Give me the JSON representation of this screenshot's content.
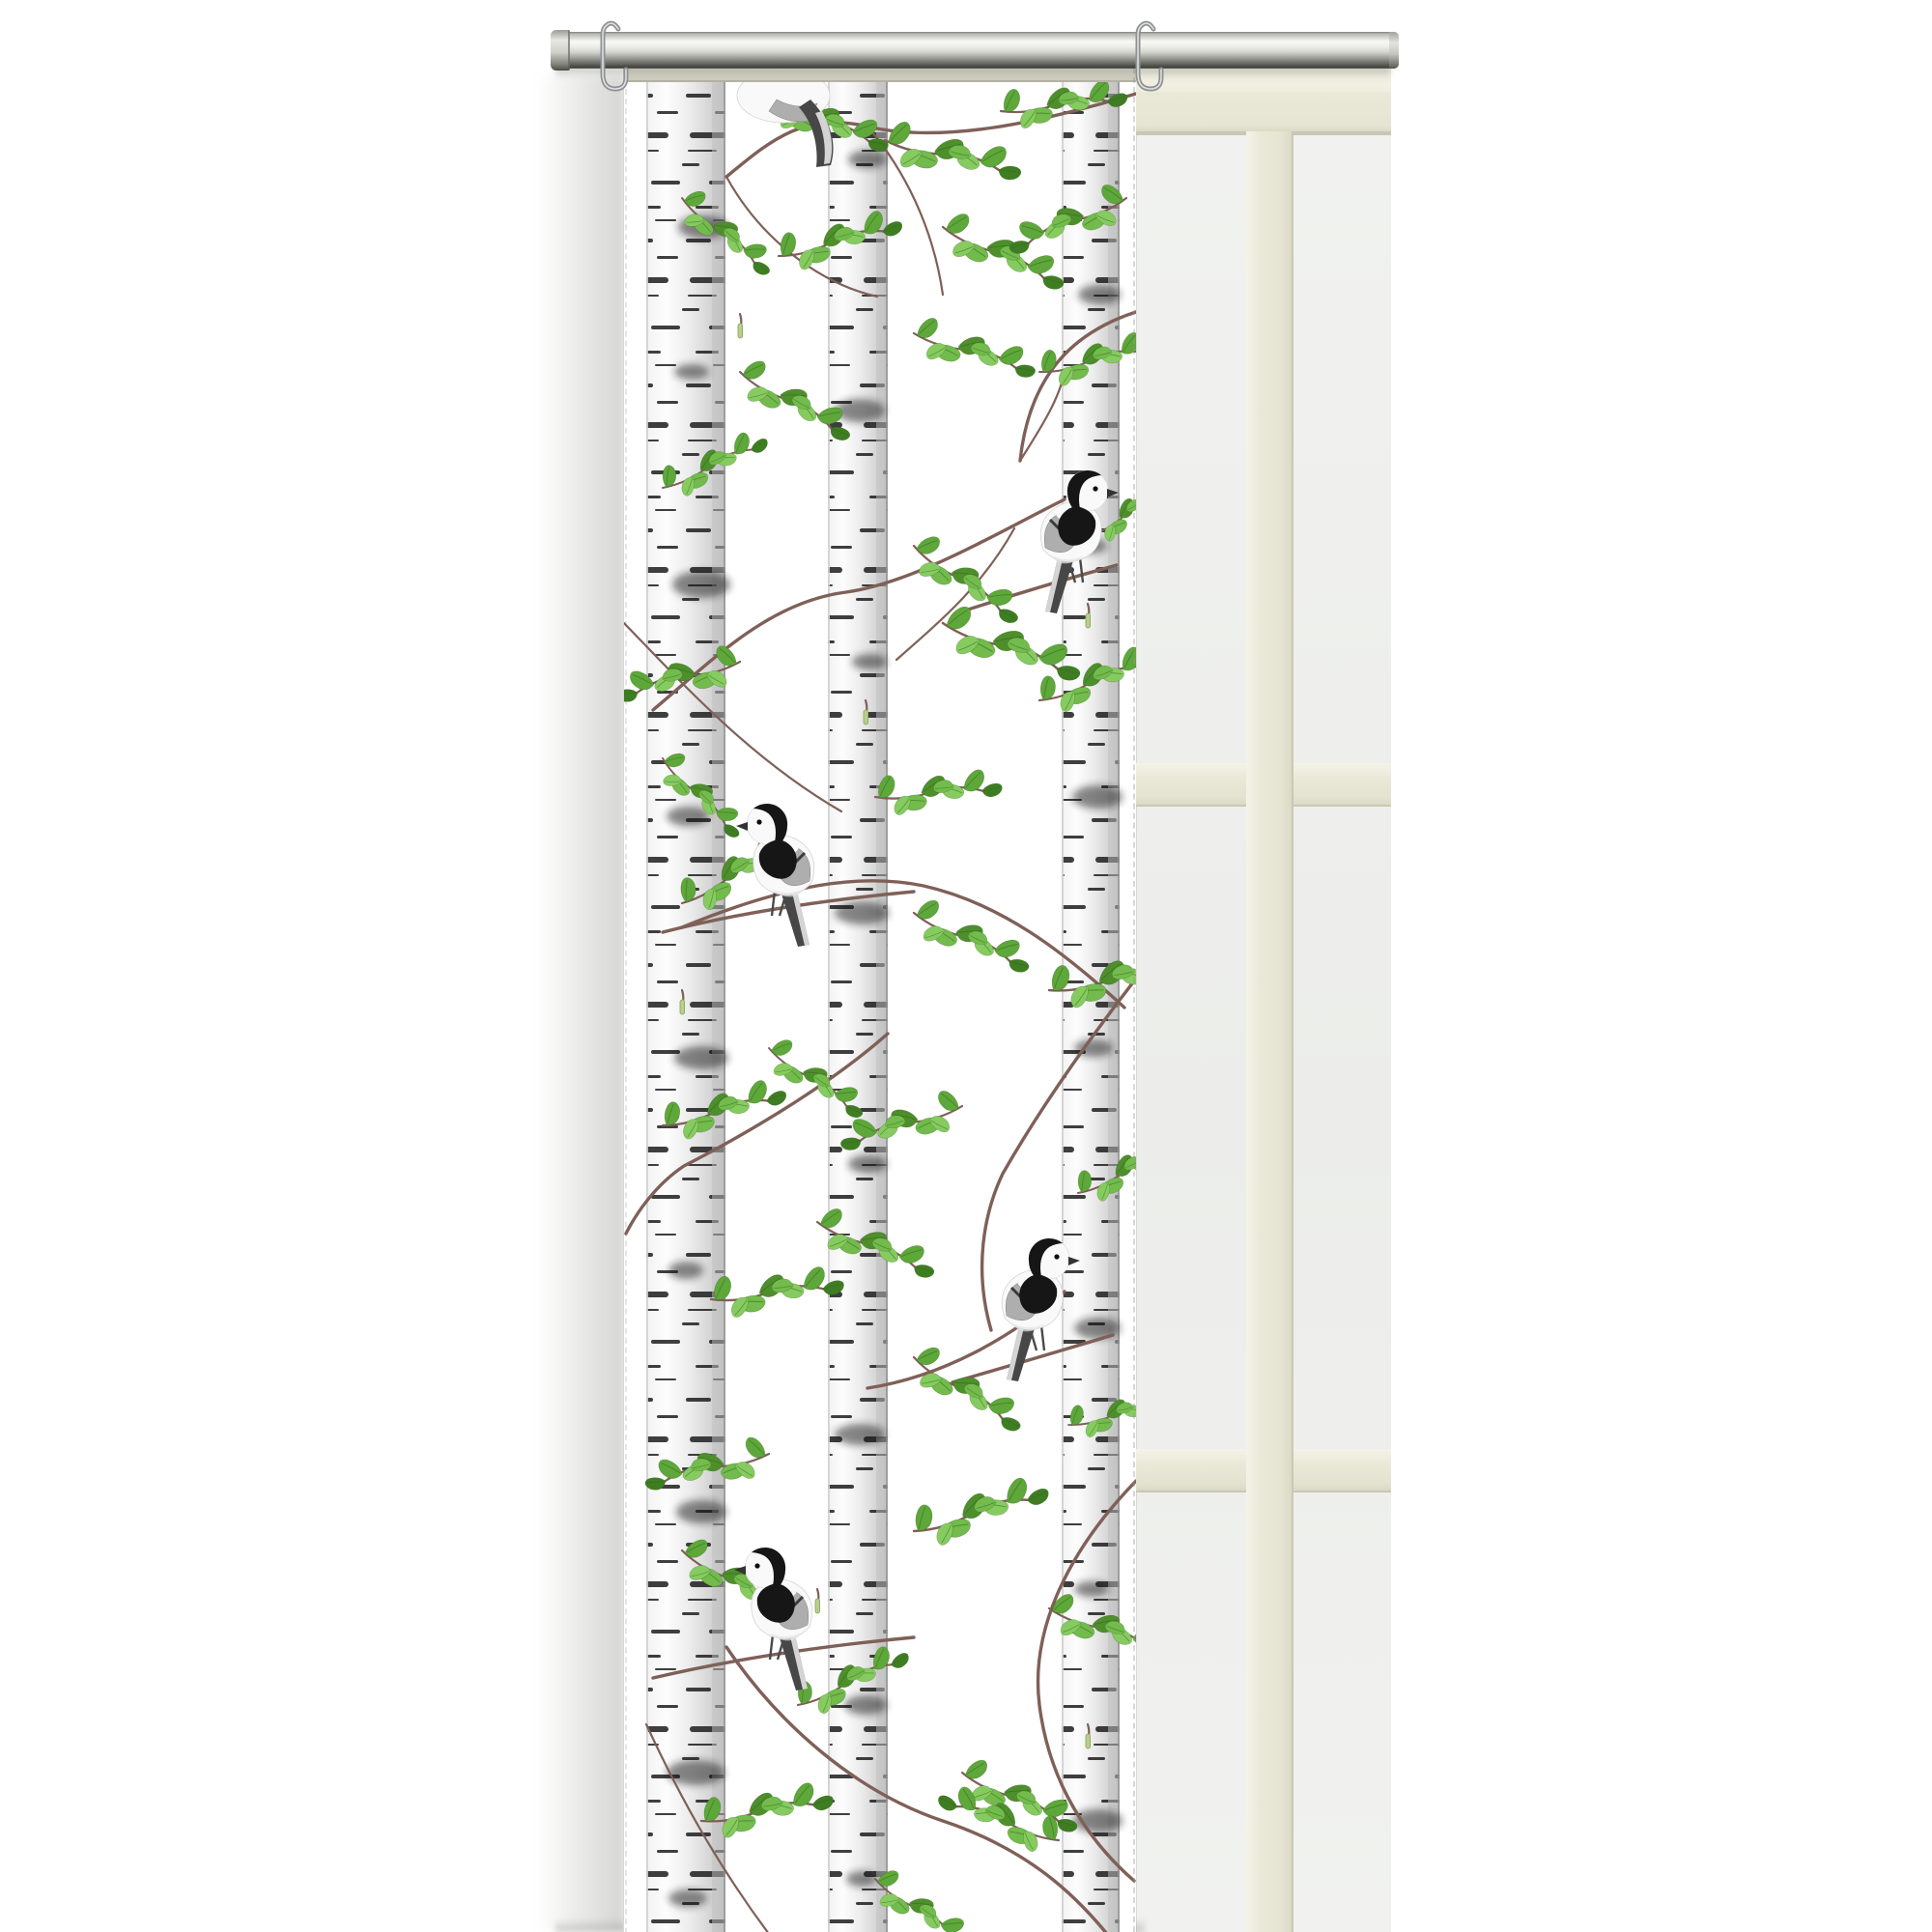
{
  "scene": {
    "description": "Product photo: white sliding panel curtain with birch trunks, green spring leaves and black-and-white wagtail birds, hanging by two metal hooks from a silver rod in front of a cream window frame with frosted panes",
    "background": "#ffffff"
  },
  "rod": {
    "label": "silver curtain rod",
    "hook_count": 2
  },
  "curtain": {
    "label": "panel curtain with birch print",
    "header_label": "greige top hem",
    "pattern": {
      "motifs": [
        "birch trunks",
        "leafy branches",
        "catkins",
        "wagtail birds"
      ],
      "trunk_count": 3,
      "bird_count": 5,
      "birds": [
        {
          "position": "top, partly hidden behind hem",
          "facing": "away"
        },
        {
          "position": "upper right trunk",
          "facing": "right"
        },
        {
          "position": "middle left trunk",
          "facing": "left"
        },
        {
          "position": "lower right trunk",
          "facing": "right"
        },
        {
          "position": "bottom left trunk",
          "facing": "left"
        }
      ]
    }
  },
  "window": {
    "label": "cream window frame with frosted panes",
    "mullions": {
      "vertical": 1,
      "horizontal": 2
    }
  },
  "css_vars": {
    "--bg": "#ffffff",
    "--rod-top-line": "#80817c",
    "--rod-hi": "#f8f8f5",
    "--rod-mid": "#d4d5cf",
    "--rod-low": "#9a9b95",
    "--rod-dark": "#60615b",
    "--rod-darker": "#3f403a",
    "--hook": "#8f9091",
    "--header": "#d8d6c8",
    "--header-edge": "#b5b3a5",
    "--frame-hi": "#f3f2e5",
    "--frame": "#eae9d8",
    "--frame-edge": "#c9c8b4",
    "--frame-shade": "#dbdac6",
    "--pane": "#f1f2ef",
    "--pane2": "#ecedea",
    "--shadow": "rgba(110,110,104,0.30)",
    "--trunk-shade": "#c2c2c2",
    "--bark-dash": "#1d1d1d",
    "--trunk-edge": "#939393",
    "--branch": "#7f6058",
    "--leaf1": "#4e8f2c",
    "--leaf2": "#5ea73a",
    "--leaf3": "#72bb4c",
    "--leaf4": "#86cb60",
    "--leaf5": "#3f7d23",
    "--vein": "#2f661b",
    "--catkin": "#b9cf8b",
    "--catkin-edge": "#87a25d",
    "--bird-dark": "#161616",
    "--bird-gray": "#aeaeae",
    "--bird-light": "#f9f9f9"
  }
}
